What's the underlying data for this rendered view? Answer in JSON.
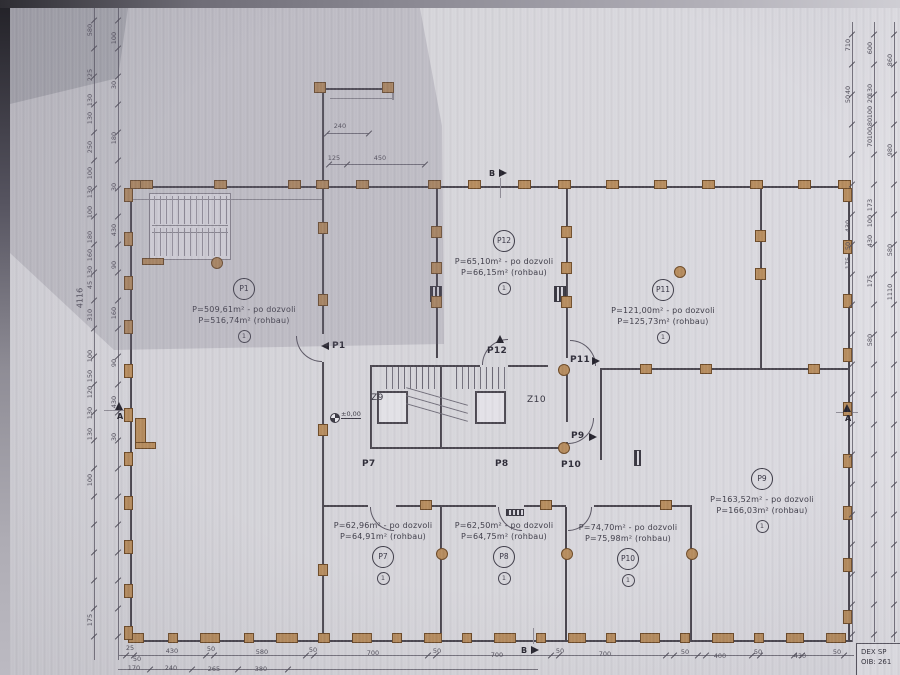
{
  "sheet": {
    "title_block": {
      "line1": "DEX SP",
      "line2": "OIB: 261"
    }
  },
  "rooms": [
    {
      "id": "P1",
      "area_permit": "P=509,61m² - po dozvoli",
      "area_shell": "P=516,74m² (rohbau)",
      "note": "1"
    },
    {
      "id": "P12",
      "area_permit": "P=65,10m² - po dozvoli",
      "area_shell": "P=66,15m² (rohbau)",
      "note": "1"
    },
    {
      "id": "P11",
      "area_permit": "P=121,00m² - po dozvoli",
      "area_shell": "P=125,73m² (rohbau)",
      "note": "1"
    },
    {
      "id": "P7",
      "area_permit": "P=62,96m² - po dozvoli",
      "area_shell": "P=64,91m² (rohbau)",
      "note": "1"
    },
    {
      "id": "P8",
      "area_permit": "P=62,50m² - po dozvoli",
      "area_shell": "P=64,75m² (rohbau)",
      "note": "1"
    },
    {
      "id": "P10",
      "area_permit": "P=74,70m² - po dozvoli",
      "area_shell": "P=75,98m² (rohbau)",
      "note": "1"
    },
    {
      "id": "P9",
      "area_permit": "P=163,52m² - po dozvoli",
      "area_shell": "P=166,03m² (rohbau)",
      "note": "1"
    }
  ],
  "core": {
    "stair_left": "Z9",
    "stair_right": "Z10",
    "level": "±0,00"
  },
  "doors": {
    "p1": "P1",
    "p7": "P7",
    "p8": "P8",
    "p9": "P9",
    "p10": "P10",
    "p11": "P11",
    "p12": "P12"
  },
  "markers": {
    "section_a": "A",
    "section_b": "B"
  },
  "dimensions": {
    "overall": "4116",
    "top": [
      "240",
      "125",
      "450"
    ],
    "bottom": [
      "25",
      "50",
      "430",
      "50",
      "580",
      "50",
      "700",
      "50",
      "700",
      "50",
      "700",
      "50",
      "400",
      "50",
      "430",
      "50"
    ],
    "bottom_row2": [
      "170",
      "240",
      "265",
      "380"
    ],
    "left_outer": [
      "580",
      "225",
      "130",
      "130",
      "250",
      "100",
      "130",
      "100",
      "180",
      "160",
      "130",
      "45",
      "310",
      "100",
      "150",
      "120",
      "130",
      "130",
      "100",
      "175"
    ],
    "left_inner": [
      "100",
      "30",
      "180",
      "30",
      "430",
      "90",
      "160",
      "90",
      "430",
      "30"
    ],
    "right_outer": [
      "710",
      "40",
      "50",
      "430",
      "50",
      "175"
    ],
    "right_mid": [
      "600",
      "130",
      "20",
      "100",
      "80",
      "100",
      "70",
      "173",
      "100",
      "430",
      "175",
      "580"
    ],
    "right_inner": [
      "860",
      "980",
      "580",
      "1110"
    ]
  }
}
